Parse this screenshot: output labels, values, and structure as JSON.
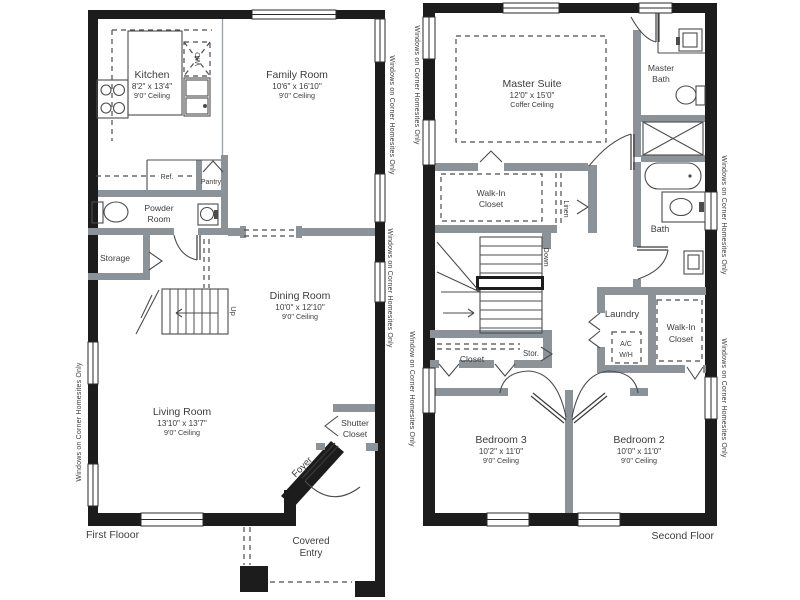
{
  "ff": {
    "kitchen_name": "Kitchen",
    "kitchen_dims": "8'2\" x 13'4\"",
    "kitchen_ceiling": "9'0\" Ceiling",
    "family_name": "Family Room",
    "family_dims": "10'6\" x 16'10\"",
    "family_ceiling": "9'0\" Ceiling",
    "dining_name": "Dining Room",
    "dining_dims": "10'0\" x 12'10\"",
    "dining_ceiling": "9'0\" Ceiling",
    "living_name": "Living Room",
    "living_dims": "13'10\" x 13'7\"",
    "living_ceiling": "9'0\" Ceiling",
    "powder_1": "Powder",
    "powder_2": "Room",
    "storage": "Storage",
    "pantry": "Pantry",
    "ref": "Ref.",
    "wd": "W/D",
    "up": "Up",
    "shutter_1": "Shutter",
    "shutter_2": "Closet",
    "foyer": "Foyer",
    "covered_1": "Covered",
    "covered_2": "Entry",
    "floor_label": "First Flooor",
    "win_label_left": "Windows on Corner Homesites Only",
    "win_label_right_1": "Windows on Corner Homesites Only",
    "win_label_right_2": "Windows on Corner Homesites Only"
  },
  "sf": {
    "master_name": "Master Suite",
    "master_dims": "12'0\" x 15'0\"",
    "master_ceiling": "Coffer Ceiling",
    "mbath_1": "Master",
    "mbath_2": "Bath",
    "wic_left_1": "Walk-In",
    "wic_left_2": "Closet",
    "linen": "Linen",
    "down": "Down",
    "bath": "Bath",
    "laundry": "Laundry",
    "acwh_1": "A/C",
    "acwh_2": "W/H",
    "wic_right_1": "Walk-In",
    "wic_right_2": "Closet",
    "closet": "Closet",
    "stor": "Stor.",
    "bed3_name": "Bedroom 3",
    "bed3_dims": "10'2\" x 11'0\"",
    "bed3_ceiling": "9'0\" Ceiling",
    "bed2_name": "Bedroom 2",
    "bed2_dims": "10'0\" x 11'0\"",
    "bed2_ceiling": "9'0\" Ceiling",
    "floor_label": "Second Floor",
    "win_label_left_1": "Windows on Corner Homesites Only",
    "win_label_left_2": "Window on Corner Homesites Only",
    "win_label_right_1": "Windows on Corner Homesites Only",
    "win_label_right_2": "Windows on Corner Homesites Only"
  },
  "colors": {
    "exterior_wall": "#1c1c1c",
    "interior_wall": "#8c9398",
    "text": "#3d3d3d",
    "background": "#ffffff"
  }
}
